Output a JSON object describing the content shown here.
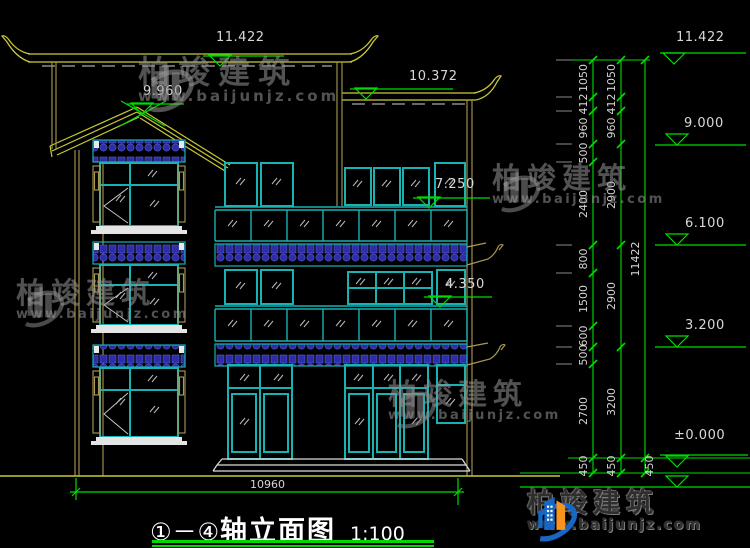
{
  "title": {
    "axis_range": "①－④",
    "name": "轴立面图",
    "scale": "1:100"
  },
  "watermark": {
    "name": "柏竣建筑",
    "url": "www.baijunjz.com"
  },
  "drawing_marks": {
    "main_roof_elev": "11.422",
    "left_gable_elev": "9.960",
    "right_roof_elev": "10.372",
    "floor3_elev": "7.250",
    "floor2_elev": "4.350",
    "overall_width": "10960"
  },
  "right_marks": {
    "top": "11.422",
    "level9": "9.000",
    "level6": "6.100",
    "level3": "3.200",
    "zero": "±0.000"
  },
  "chains": {
    "chain1": [
      "1050",
      "412",
      "960",
      "500",
      "2400",
      "800",
      "1500",
      "600",
      "500",
      "2700",
      "450"
    ],
    "chain2": [
      "1050",
      "412",
      "960",
      "2900",
      "2900",
      "3200",
      "450"
    ],
    "chain3": [
      "11422",
      "450"
    ]
  }
}
